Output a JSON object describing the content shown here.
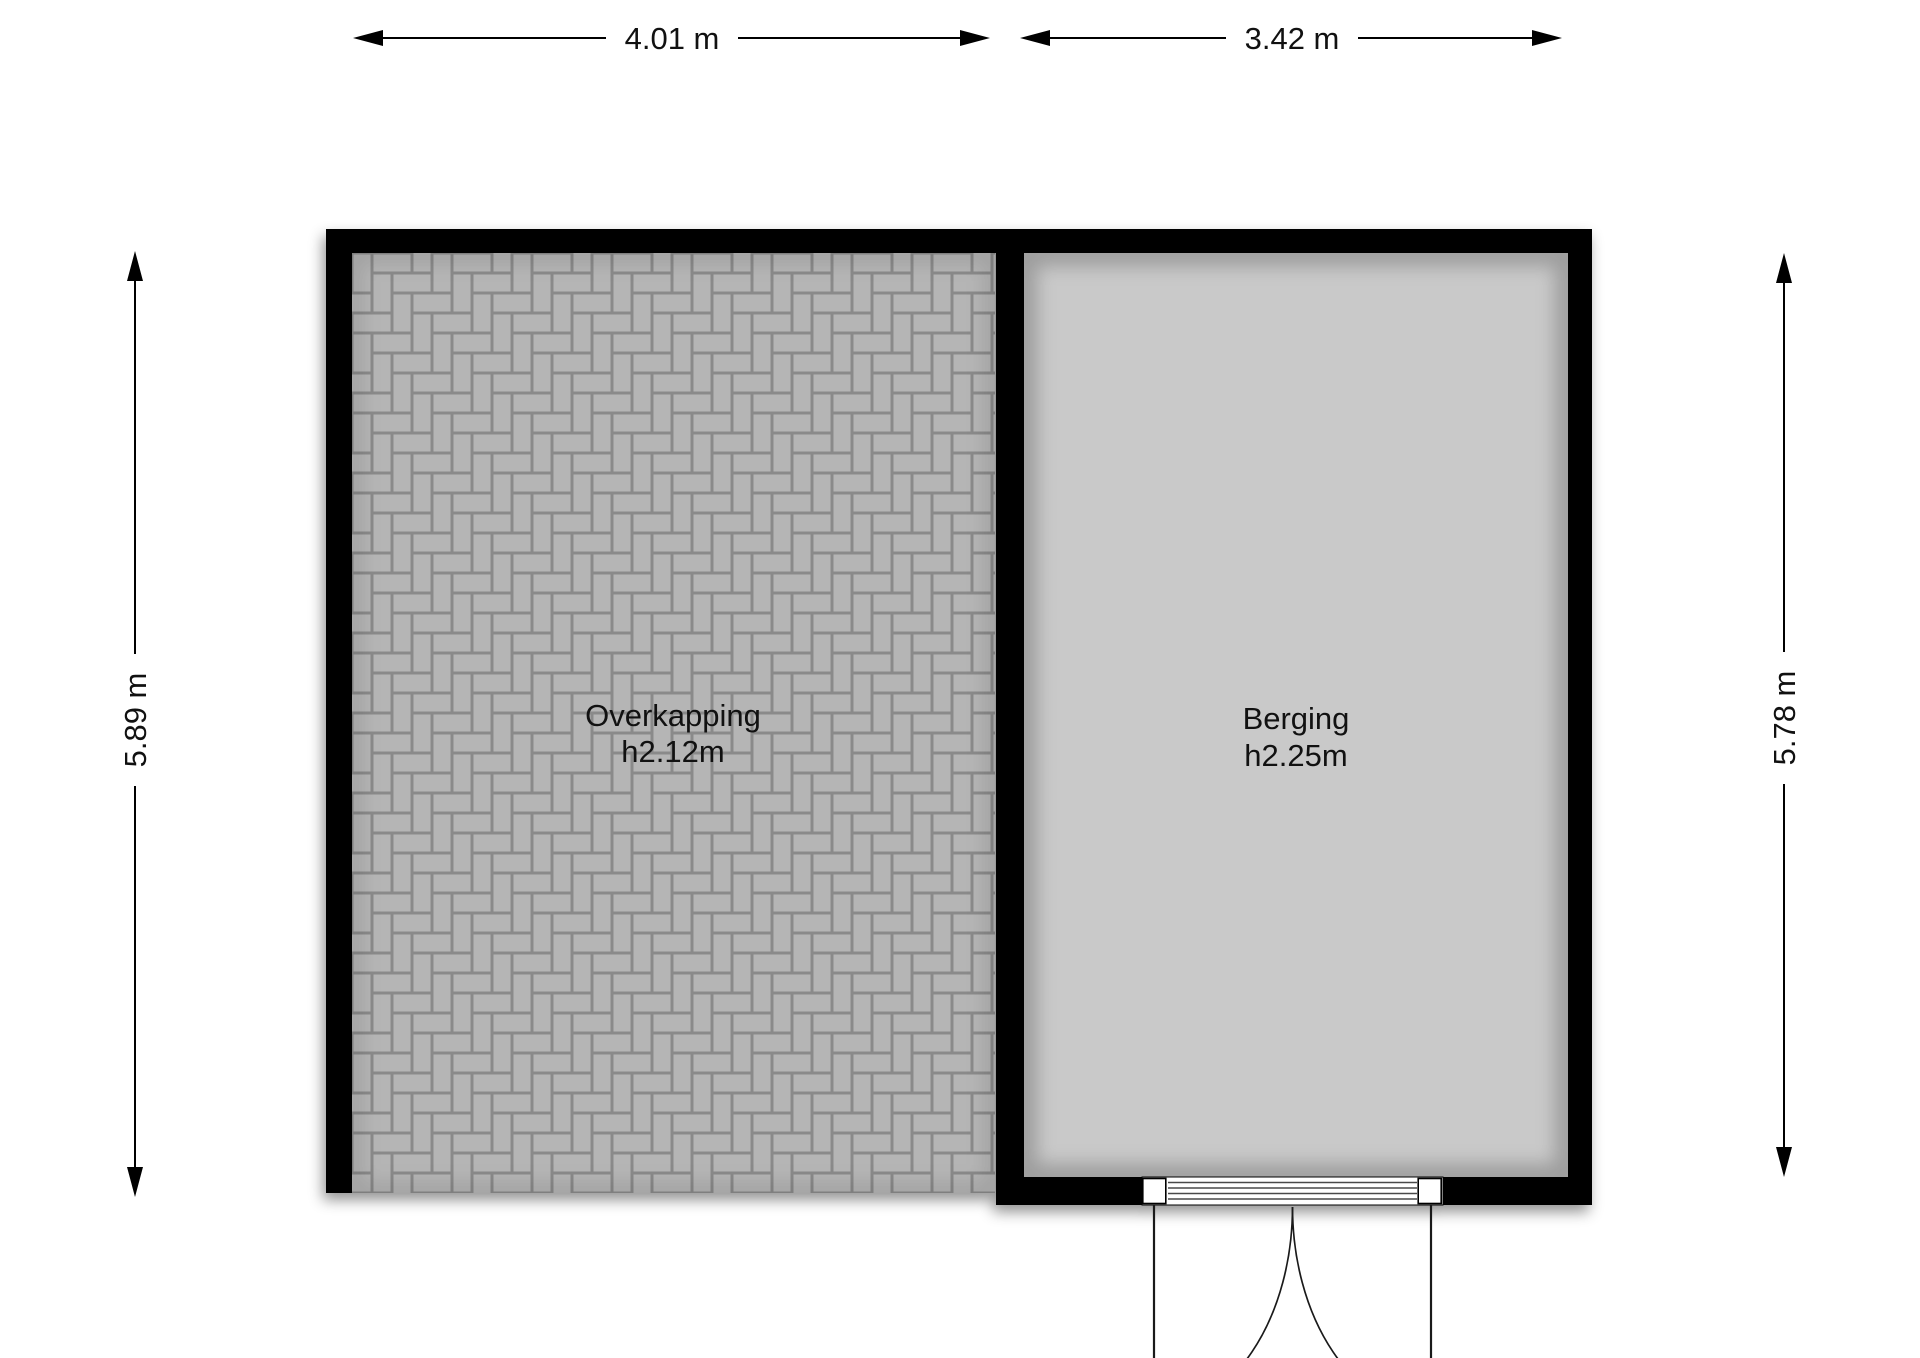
{
  "floorplan": {
    "dimensions": {
      "top_left": {
        "label": "4.01 m"
      },
      "top_right": {
        "label": "3.42 m"
      },
      "left": {
        "label": "5.89 m"
      },
      "right": {
        "label": "5.78 m"
      }
    },
    "rooms": [
      {
        "name": "Overkapping",
        "height": "h2.12m",
        "floor_style": "paved-herringbone"
      },
      {
        "name": "Berging",
        "height": "h2.25m",
        "floor_style": "plain"
      }
    ],
    "colors": {
      "wall": "#000000",
      "background": "#ffffff",
      "berging_floor": "#c9c9c9",
      "paver_brick": "#b5b5b5",
      "paver_joint": "#8a8a8a",
      "text": "#111111"
    }
  }
}
